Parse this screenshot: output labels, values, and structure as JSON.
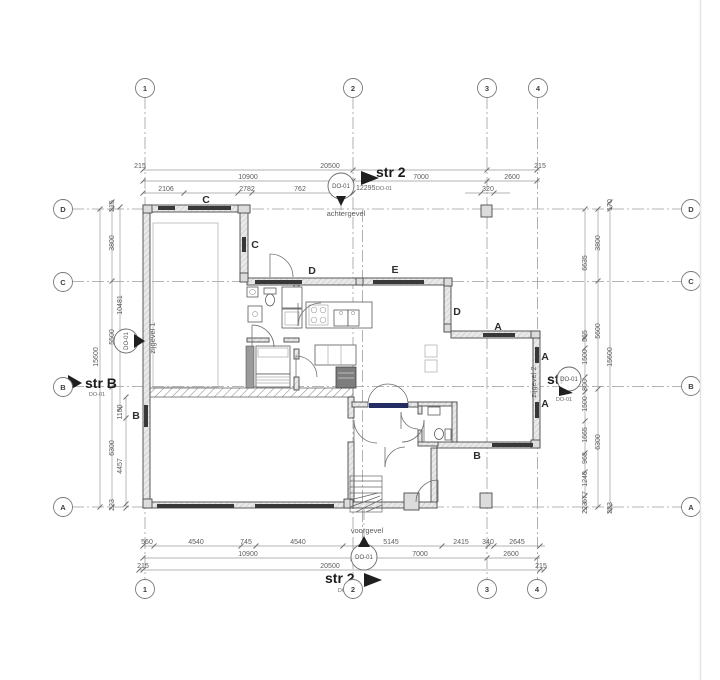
{
  "colors": {
    "accent_navy": "#232d63",
    "line": "#4a4a4a",
    "dim_line": "#9a9a9a",
    "window": "#383838",
    "background": "#ffffff"
  },
  "grid_bubbles": {
    "top": [
      {
        "label": "1",
        "x": 145,
        "y": 88
      },
      {
        "label": "2",
        "x": 353,
        "y": 88
      },
      {
        "label": "3",
        "x": 487,
        "y": 88
      },
      {
        "label": "4",
        "x": 538,
        "y": 88
      }
    ],
    "bottom": [
      {
        "label": "1",
        "x": 145,
        "y": 589
      },
      {
        "label": "2",
        "x": 353,
        "y": 589
      },
      {
        "label": "3",
        "x": 487,
        "y": 589
      },
      {
        "label": "4",
        "x": 537,
        "y": 589
      }
    ],
    "left": [
      {
        "label": "D",
        "x": 63,
        "y": 209
      },
      {
        "label": "C",
        "x": 63,
        "y": 282
      },
      {
        "label": "B",
        "x": 63,
        "y": 387
      },
      {
        "label": "A",
        "x": 63,
        "y": 507
      }
    ],
    "right": [
      {
        "label": "D",
        "x": 691,
        "y": 209
      },
      {
        "label": "C",
        "x": 691,
        "y": 281
      },
      {
        "label": "B",
        "x": 691,
        "y": 386
      },
      {
        "label": "A",
        "x": 691,
        "y": 507
      }
    ]
  },
  "markers": {
    "top": {
      "label": "str 2",
      "ref": "DO-01",
      "bubble": "DO-01",
      "value": "12295"
    },
    "bottom": {
      "label": "str 2",
      "ref": "DO-01",
      "bubble": "DO-01"
    },
    "left": {
      "label": "str B",
      "ref": "DO-01"
    },
    "left_wall": {
      "bubble": "DO-01"
    },
    "right": {
      "label": "str",
      "ref": "DO-01",
      "bubble": "DO-01"
    }
  },
  "facade_labels": [
    {
      "text": "achtergevel",
      "x": 346,
      "y": 216,
      "rot": 0
    },
    {
      "text": "voorgevel",
      "x": 367,
      "y": 533,
      "rot": 0
    },
    {
      "text": "zijgevel 1",
      "x": 155,
      "y": 338,
      "rot": -90
    },
    {
      "text": "zijgevel 2",
      "x": 536,
      "y": 382,
      "rot": -90
    }
  ],
  "wall_type_labels": [
    {
      "text": "C",
      "x": 206,
      "y": 203
    },
    {
      "text": "C",
      "x": 255,
      "y": 248
    },
    {
      "text": "D",
      "x": 312,
      "y": 274
    },
    {
      "text": "E",
      "x": 395,
      "y": 273
    },
    {
      "text": "D",
      "x": 457,
      "y": 315
    },
    {
      "text": "A",
      "x": 498,
      "y": 330
    },
    {
      "text": "A",
      "x": 545,
      "y": 360
    },
    {
      "text": "A",
      "x": 545,
      "y": 407
    },
    {
      "text": "B",
      "x": 477,
      "y": 459
    },
    {
      "text": "B",
      "x": 136,
      "y": 419
    }
  ],
  "dimensions": {
    "top": [
      {
        "text": "215",
        "x": 140,
        "y": 168
      },
      {
        "text": "20500",
        "x": 330,
        "y": 168
      },
      {
        "text": "215",
        "x": 540,
        "y": 168
      },
      {
        "text": "10900",
        "x": 248,
        "y": 179
      },
      {
        "text": "7000",
        "x": 421,
        "y": 179
      },
      {
        "text": "2600",
        "x": 512,
        "y": 179
      },
      {
        "text": "2106",
        "x": 166,
        "y": 191
      },
      {
        "text": "2782",
        "x": 247,
        "y": 191
      },
      {
        "text": "762",
        "x": 300,
        "y": 191
      },
      {
        "text": "320",
        "x": 488,
        "y": 191
      }
    ],
    "bottom": [
      {
        "text": "560",
        "x": 147,
        "y": 544
      },
      {
        "text": "4540",
        "x": 196,
        "y": 544
      },
      {
        "text": "745",
        "x": 246,
        "y": 544
      },
      {
        "text": "4540",
        "x": 298,
        "y": 544
      },
      {
        "text": "5145",
        "x": 391,
        "y": 544
      },
      {
        "text": "2415",
        "x": 461,
        "y": 544
      },
      {
        "text": "340",
        "x": 488,
        "y": 544
      },
      {
        "text": "2645",
        "x": 517,
        "y": 544
      },
      {
        "text": "10900",
        "x": 248,
        "y": 556
      },
      {
        "text": "7000",
        "x": 420,
        "y": 556
      },
      {
        "text": "2600",
        "x": 511,
        "y": 556
      },
      {
        "text": "215",
        "x": 143,
        "y": 568
      },
      {
        "text": "20500",
        "x": 330,
        "y": 568
      },
      {
        "text": "215",
        "x": 541,
        "y": 568
      }
    ],
    "left": [
      {
        "text": "215",
        "x": 114,
        "y": 206
      },
      {
        "text": "3800",
        "x": 114,
        "y": 243
      },
      {
        "text": "10481",
        "x": 122,
        "y": 305
      },
      {
        "text": "5500",
        "x": 114,
        "y": 337
      },
      {
        "text": "15600",
        "x": 98,
        "y": 357
      },
      {
        "text": "1100",
        "x": 122,
        "y": 412
      },
      {
        "text": "6300",
        "x": 114,
        "y": 448
      },
      {
        "text": "4457",
        "x": 122,
        "y": 466
      },
      {
        "text": "223",
        "x": 114,
        "y": 505
      }
    ],
    "right": [
      {
        "text": "170",
        "x": 612,
        "y": 205
      },
      {
        "text": "3800",
        "x": 600,
        "y": 243
      },
      {
        "text": "6635",
        "x": 587,
        "y": 263
      },
      {
        "text": "5600",
        "x": 600,
        "y": 331
      },
      {
        "text": "565",
        "x": 587,
        "y": 336
      },
      {
        "text": "1500",
        "x": 587,
        "y": 357
      },
      {
        "text": "15600",
        "x": 612,
        "y": 357
      },
      {
        "text": "800",
        "x": 587,
        "y": 385
      },
      {
        "text": "1500",
        "x": 587,
        "y": 404
      },
      {
        "text": "1665",
        "x": 587,
        "y": 435
      },
      {
        "text": "6300",
        "x": 600,
        "y": 442
      },
      {
        "text": "968",
        "x": 587,
        "y": 458
      },
      {
        "text": "1240",
        "x": 587,
        "y": 479
      },
      {
        "text": "677",
        "x": 587,
        "y": 497
      },
      {
        "text": "223",
        "x": 587,
        "y": 508
      },
      {
        "text": "223",
        "x": 612,
        "y": 508
      }
    ]
  }
}
